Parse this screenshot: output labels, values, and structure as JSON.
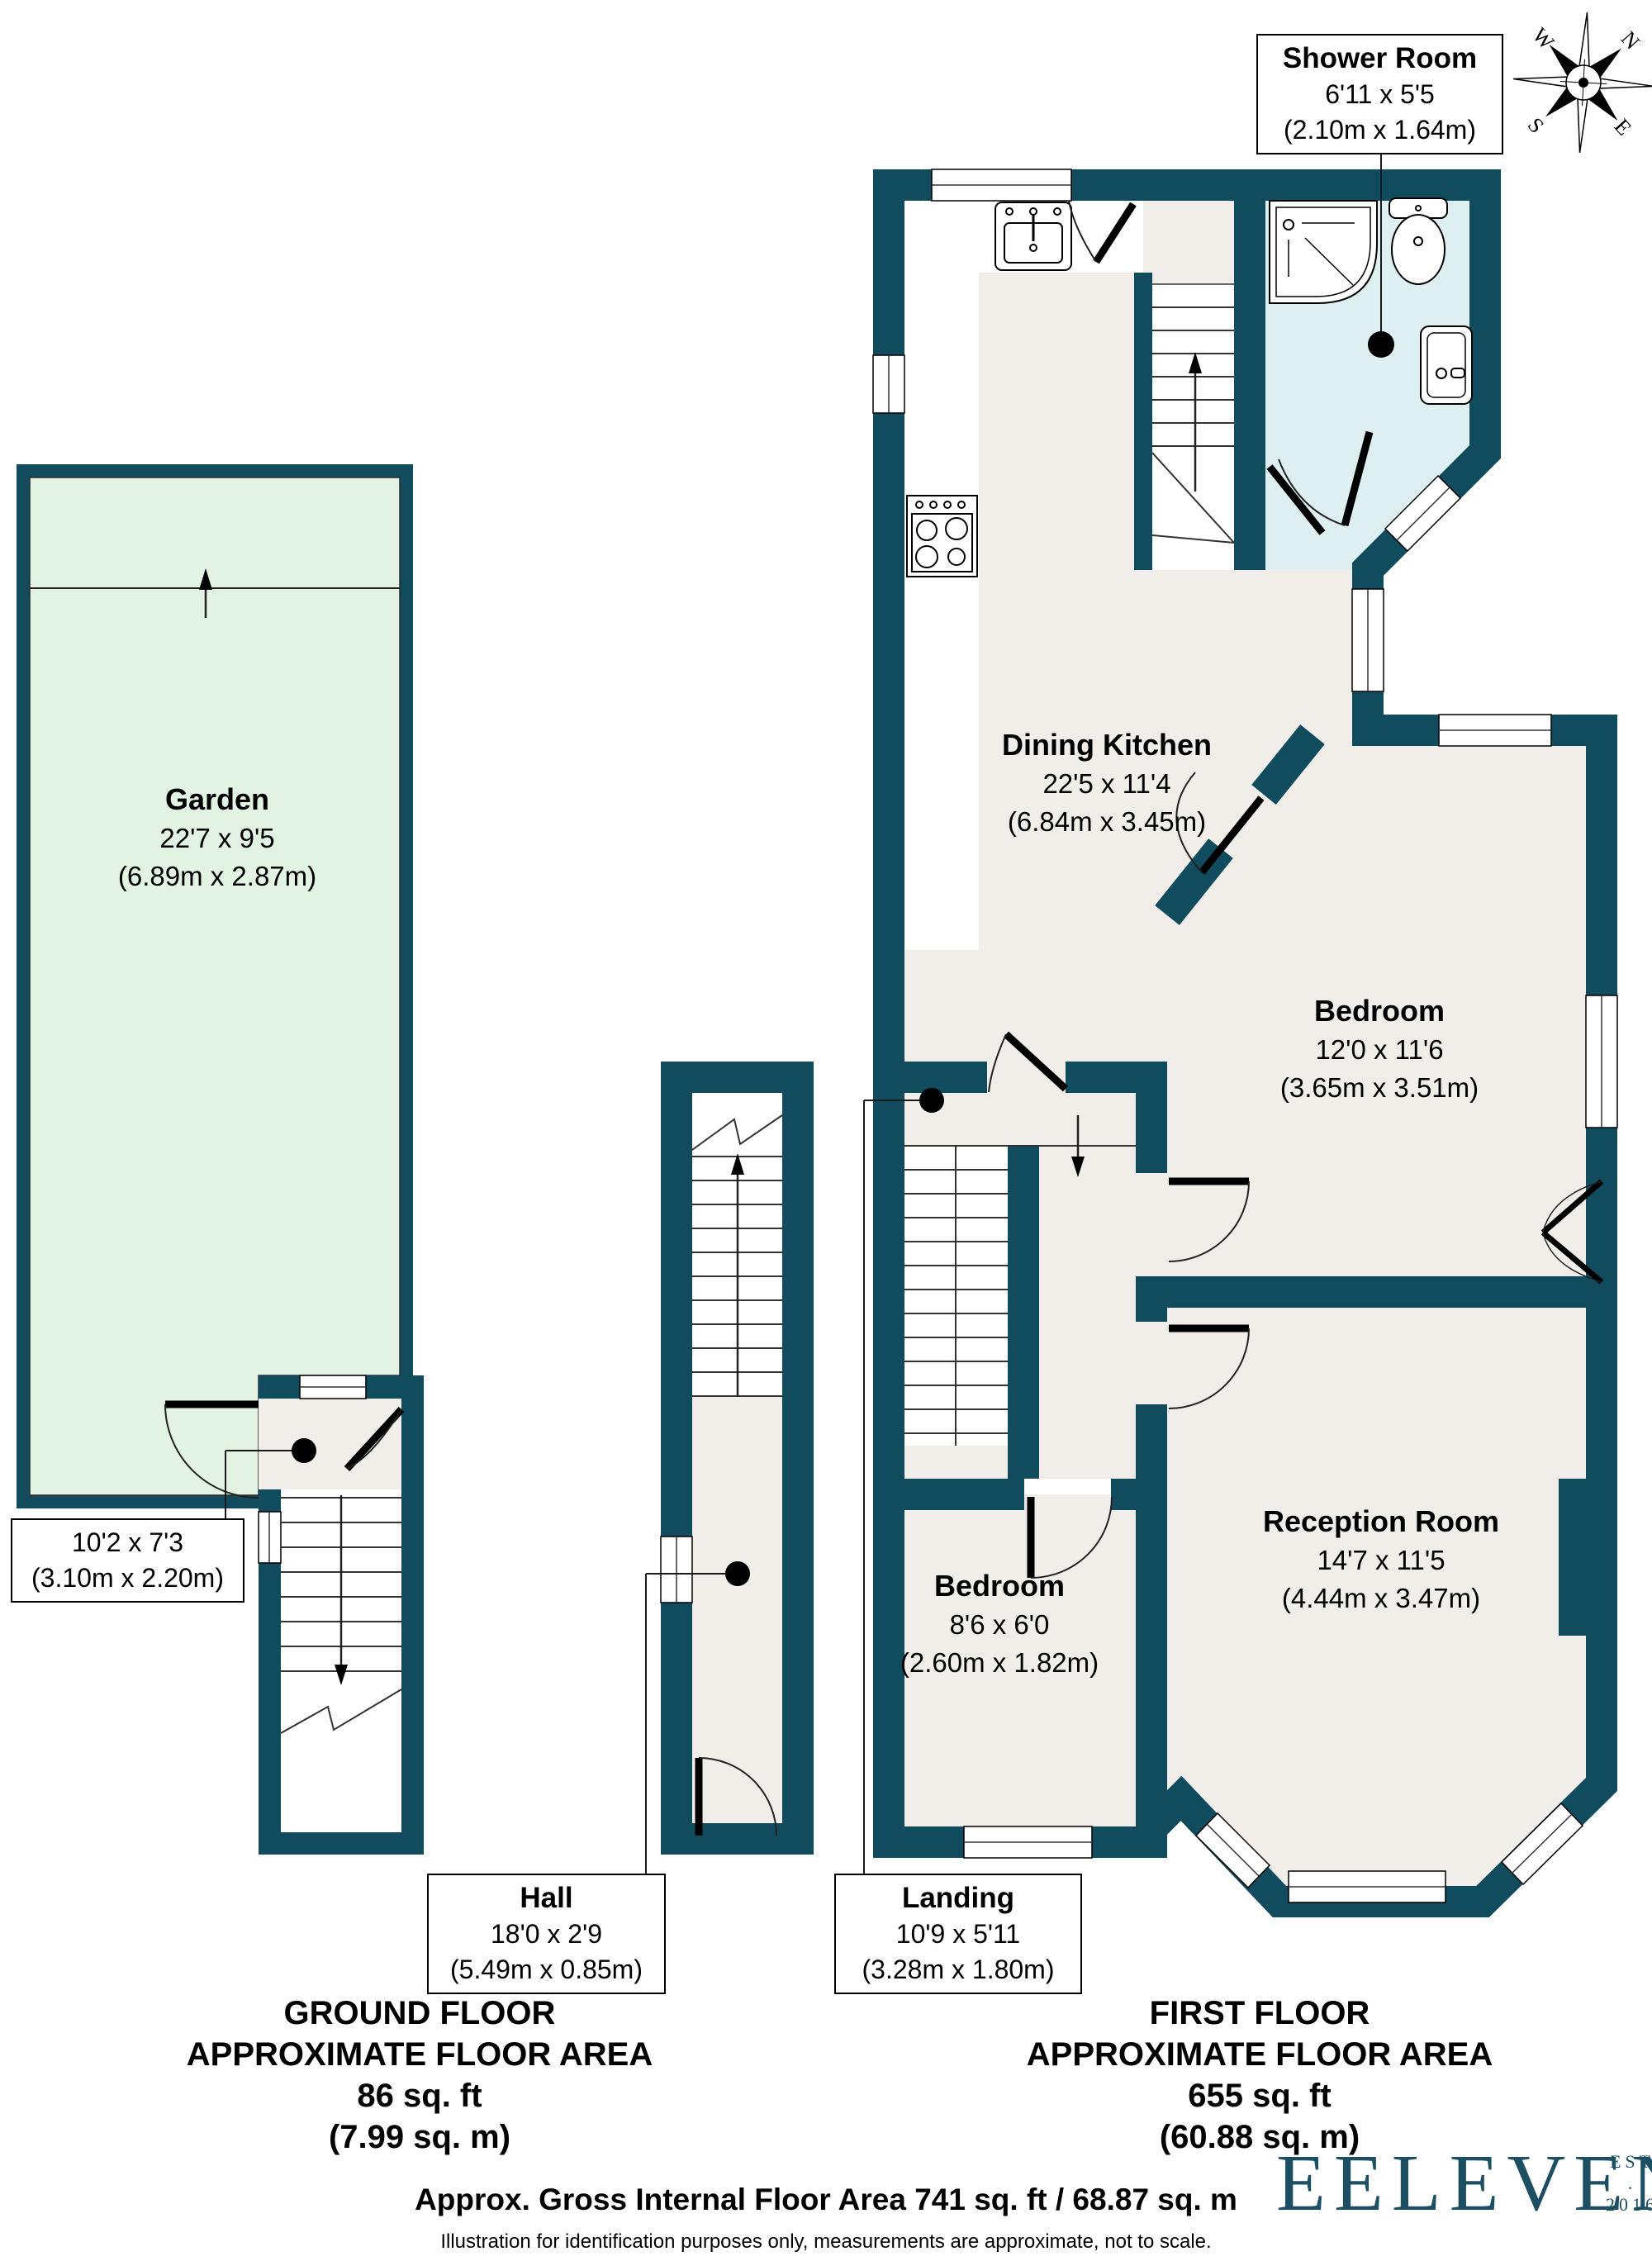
{
  "labels": {
    "shower_room": {
      "name": "Shower Room",
      "imperial": "6'11 x 5'5",
      "metric": "(2.10m x 1.64m)"
    },
    "garden": {
      "name": "Garden",
      "imperial": "22'7 x 9'5",
      "metric": "(6.89m x 2.87m)"
    },
    "dining_kitchen": {
      "name": "Dining Kitchen",
      "imperial": "22'5 x 11'4",
      "metric": "(6.84m x 3.45m)"
    },
    "bedroom_large": {
      "name": "Bedroom",
      "imperial": "12'0 x 11'6",
      "metric": "(3.65m x 3.51m)"
    },
    "reception": {
      "name": "Reception Room",
      "imperial": "14'7 x 11'5",
      "metric": "(4.44m x 3.47m)"
    },
    "bedroom_small": {
      "name": "Bedroom",
      "imperial": "8'6 x 6'0",
      "metric": "(2.60m x 1.82m)"
    },
    "ground_hall": {
      "imperial": "10'2 x 7'3",
      "metric": "(3.10m x 2.20m)"
    },
    "hall": {
      "name": "Hall",
      "imperial": "18'0 x 2'9",
      "metric": "(5.49m x 0.85m)"
    },
    "landing": {
      "name": "Landing",
      "imperial": "10'9 x 5'11",
      "metric": "(3.28m x 1.80m)"
    }
  },
  "floors": {
    "ground": {
      "title": "GROUND FLOOR",
      "subtitle": "APPROXIMATE FLOOR AREA",
      "area_ft": "86 sq. ft",
      "area_m": "(7.99 sq. m)"
    },
    "first": {
      "title": "FIRST FLOOR",
      "subtitle": "APPROXIMATE FLOOR AREA",
      "area_ft": "655 sq. ft",
      "area_m": "(60.88 sq. m)"
    }
  },
  "footer": {
    "gross": "Approx. Gross Internal Floor Area 741 sq. ft / 68.87 sq. m",
    "disclaimer": "Illustration for identification purposes only, measurements are approximate, not to scale."
  },
  "logo": {
    "brand": "EELEVEN",
    "est": "EST",
    "dot": ".",
    "year": "2016"
  },
  "compass": {
    "n": "N",
    "e": "E",
    "s": "S",
    "w": "W"
  },
  "colors": {
    "wall": "#114b5e",
    "floor": "#f1ede8",
    "garden": "#e2f3e3",
    "shower": "#ddeff1",
    "logo": "#1d4f63"
  }
}
